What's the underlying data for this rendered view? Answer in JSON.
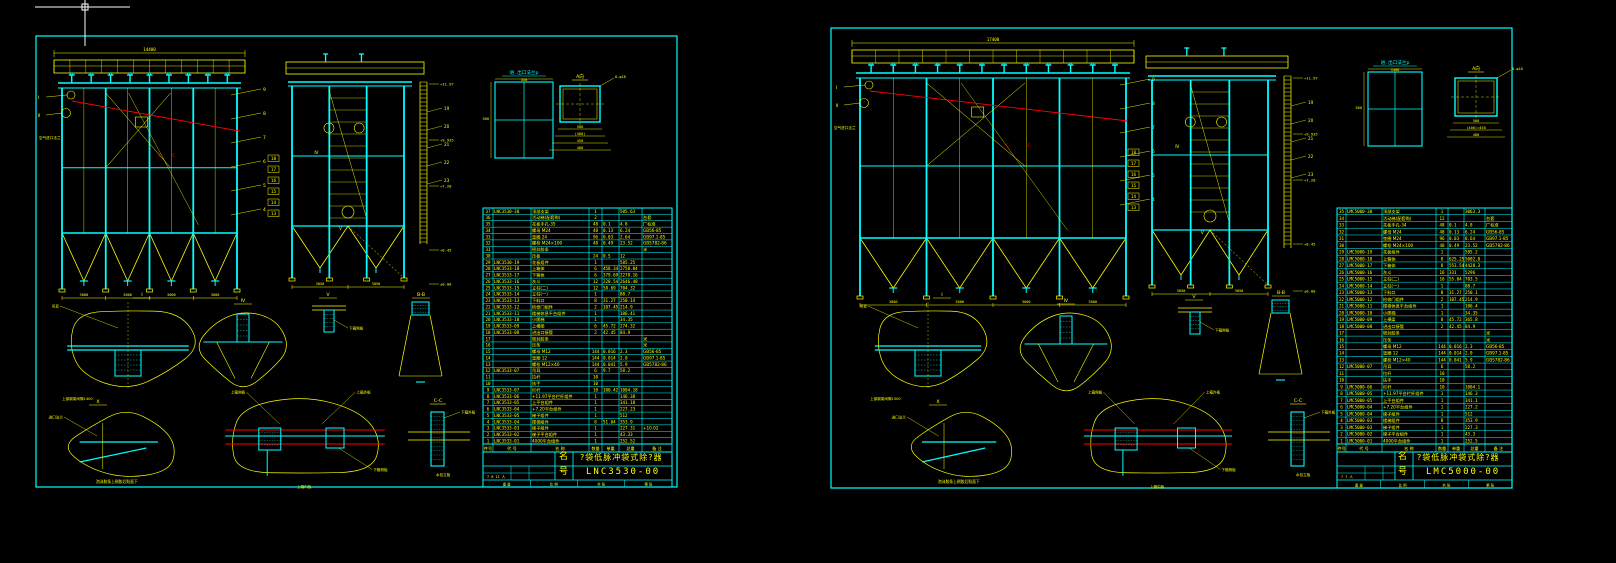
{
  "app": {
    "background": "#000000",
    "colors": {
      "cyan": "#00ffff",
      "yellow": "#ffff00",
      "red": "#ff0000",
      "white": "#ffffff"
    }
  },
  "cursor": {
    "type": "crosshair-with-pickbox"
  },
  "sheets": [
    {
      "id": "left",
      "title_block": {
        "name_label": "名",
        "name_value": "?袋低脉冲袋式除?器",
        "no_label": "号",
        "no_value": "LNC3530-00",
        "bottom_cells": [
          "重 量",
          "比 例",
          "共 张",
          "第 张"
        ],
        "sign_cells": "7 8 11 人"
      },
      "views": {
        "main": {
          "top_dim": "14400",
          "bottom_dims": [
            "3000",
            "3000",
            "3000",
            "3000"
          ],
          "balloons_right": [
            "9",
            "8",
            "7",
            "6",
            "5",
            "4"
          ],
          "left_markers": [
            "Ⅰ",
            "Ⅱ"
          ],
          "air_inlet_label": "空气进口法兰",
          "section_marks": [
            "C",
            "C"
          ]
        },
        "side": {
          "elevations": [
            "+11.97",
            "+9.935",
            "+7.20",
            "+0.45",
            "±0.00"
          ],
          "balloons_right": [
            "19",
            "20",
            "21",
            "22",
            "23"
          ],
          "balloons_left": [
            "18",
            "17",
            "16",
            "15",
            "14",
            "13"
          ],
          "markers": [
            "Ⅳ",
            "Ⅴ"
          ],
          "bottom_dims": [
            "3050",
            "3050"
          ]
        },
        "flange": {
          "label": "进, 出口法兰p",
          "width_dim": "350",
          "height_dim": "500"
        },
        "a_view": {
          "label": "A向",
          "note": "8-φ18",
          "dims": [
            "500",
            "(400)",
            "450",
            "480"
          ]
        },
        "details": {
          "labels": [
            "Ⅰ",
            "Ⅳ",
            "Ⅴ",
            "B-B",
            "Ⅹ",
            "C-C"
          ],
          "notes": [
            "吊耳",
            "上部钢架间隙1400",
            "上箱侧板",
            "下箱侧板",
            "上箱内板",
            "上箱外板",
            "下箱外板",
            "进口法兰",
            "泡沫胶条上刷胶后贴面下",
            "水包立板"
          ]
        }
      },
      "bom": {
        "headers": [
          "件号",
          "代  号",
          "名  称",
          "数量",
          "单重",
          "总重",
          "备 注"
        ],
        "rows": [
          [
            "37",
            "LNC3530-30",
            "顶部支架",
            "1",
            "",
            "505.63",
            ""
          ],
          [
            "36",
            "",
            "活动梯(配套购)",
            "2",
            "",
            "",
            "台套"
          ],
          [
            "35",
            "",
            "花板手孔-35",
            "48",
            "0.1",
            "4.8",
            "厂标准"
          ],
          [
            "34",
            "",
            "螺母 M24",
            "48",
            "0.13",
            "6.24",
            "GB56-85"
          ],
          [
            "33",
            "",
            "垫圈 24",
            "96",
            "0.03",
            "2.64",
            "GB97.1-85"
          ],
          [
            "32",
            "",
            "螺栓 M24×100",
            "48",
            "0.49",
            "23.52",
            "GB5782-86"
          ],
          [
            "31",
            "",
            "密封胶条",
            "",
            "",
            "",
            "米"
          ],
          [
            "30",
            "",
            "压板",
            "24",
            "0.5",
            "12",
            ""
          ],
          [
            "29",
            "LNC3530-19",
            "花板组件",
            "1",
            "",
            "585.25",
            ""
          ],
          [
            "28",
            "LNC3533-18",
            "上箱体",
            "6",
            "458.34",
            "2750.04",
            ""
          ],
          [
            "27",
            "LNC3533-17",
            "下箱体",
            "6",
            "379.69",
            "2278.16",
            ""
          ],
          [
            "26",
            "LNC3533-16",
            "灰斗",
            "12",
            "220.54",
            "2646.48",
            ""
          ],
          [
            "25",
            "LNC3533-15",
            "立柱(二)",
            "12",
            "58.69",
            "704.32",
            ""
          ],
          [
            "24",
            "LNC3533-14",
            "立柱(一)",
            "1",
            "",
            "88.7",
            ""
          ],
          [
            "23",
            "LNC3533-13",
            "下料口",
            "8",
            "31.27",
            "250.14",
            ""
          ],
          [
            "22",
            "LNC3533-12",
            "检修门组件",
            "2",
            "107.45",
            "214.9",
            ""
          ],
          [
            "21",
            "LNC3533-11",
            "楼梯休息平台组件",
            "1",
            "",
            "106.41",
            ""
          ],
          [
            "20",
            "LNC3533-10",
            "小爬梯",
            "1",
            "",
            "34.35",
            ""
          ],
          [
            "19",
            "LNC3533-09",
            "上横梁",
            "6",
            "45.72",
            "274.32",
            ""
          ],
          [
            "18",
            "LNC3533-08",
            "进出口接管",
            "2",
            "42.45",
            "84.9",
            ""
          ],
          [
            "17",
            "",
            "密封胶条",
            "",
            "",
            "",
            "米"
          ],
          [
            "16",
            "",
            "压条",
            "",
            "",
            "",
            "米"
          ],
          [
            "15",
            "",
            "螺母 M12",
            "144",
            "0.016",
            "2.3",
            "GB56-85"
          ],
          [
            "14",
            "",
            "垫圈 12",
            "144",
            "0.014",
            "2.0",
            "GB97.1-85"
          ],
          [
            "13",
            "",
            "螺栓 M12×40",
            "144",
            "0.041",
            "5.9",
            "GB5782-86"
          ],
          [
            "12",
            "LNC3533-07",
            "吊耳",
            "6",
            "9.7",
            "58.2",
            ""
          ],
          [
            "11",
            "",
            "拉杆",
            "10",
            "",
            "",
            ""
          ],
          [
            "10",
            "",
            "扶手",
            "10",
            "",
            "",
            ""
          ],
          [
            "9",
            "LNC3533-07",
            "栏杆",
            "10",
            "100.42",
            "1004.18",
            ""
          ],
          [
            "8",
            "LNC3533-06",
            "+11.97平台栏杆组件",
            "1",
            "",
            "146.38",
            ""
          ],
          [
            "7",
            "LNC3533-05",
            "上平台组件",
            "1",
            "",
            "341.18",
            ""
          ],
          [
            "6",
            "LNC3533-04",
            "+7.20平台组件",
            "1",
            "",
            "227.23",
            ""
          ],
          [
            "5",
            "LNC3533-05",
            "梯子组件",
            "1",
            "",
            "512",
            ""
          ],
          [
            "4",
            "LNC3533-04",
            "楼梯组件",
            "8",
            "51.04",
            "353.9",
            ""
          ],
          [
            "3",
            "LNC3533-03",
            "梯子组件",
            "1",
            "",
            "227.31",
            "+10.02"
          ],
          [
            "2",
            "LNC3533-02",
            "梯子平台组件",
            "1",
            "",
            "43.33",
            ""
          ],
          [
            "1",
            "LNC3533-01",
            "4000平台组件",
            "1",
            "",
            "252.52",
            ""
          ]
        ]
      }
    },
    {
      "id": "right",
      "title_block": {
        "name_label": "名",
        "name_value": "?袋低脉冲袋式除?器",
        "no_label": "号",
        "no_value": "LMC5000-00",
        "bottom_cells": [
          "重 量",
          "比 例",
          "共 张",
          "第 张"
        ],
        "sign_cells": "7 7 人"
      },
      "views": {
        "main": {
          "top_dim": "17400",
          "bottom_dims": [
            "3000",
            "3000",
            "3000",
            "3000"
          ],
          "balloons_right": [
            "9",
            "8",
            "7",
            "6",
            "5",
            "4"
          ],
          "left_markers": [
            "Ⅰ",
            "Ⅱ"
          ],
          "air_inlet_label": "空气进口法兰",
          "section_marks": [
            "C",
            "C"
          ]
        },
        "side": {
          "elevations": [
            "+11.97",
            "+9.935",
            "+7.20",
            "+0.45",
            "±0.00"
          ],
          "balloons_right": [
            "19",
            "20",
            "21",
            "22",
            "23"
          ],
          "balloons_left": [
            "18",
            "17",
            "16",
            "15",
            "14",
            "13"
          ],
          "markers": [
            "Ⅳ",
            "Ⅴ"
          ],
          "bottom_dims": [
            "3050",
            "3050"
          ]
        },
        "flange": {
          "label": "进, 出口法兰p",
          "width_dim": "3480",
          "height_dim": "500"
        },
        "a_view": {
          "label": "A向",
          "note": "B-φ18",
          "dims": [
            "500",
            "(400)=450",
            "480"
          ]
        },
        "details": {
          "labels": [
            "Ⅰ",
            "Ⅳ",
            "Ⅴ",
            "B-B",
            "Ⅹ",
            "C-C"
          ],
          "notes": [
            "吊耳",
            "上部钢架间隙1500",
            "上箱侧板",
            "下箱侧板",
            "上箱内板",
            "上箱外板",
            "下箱外板",
            "进口法兰",
            "泡沫胶条上刷胶后贴面下",
            "水包立板"
          ]
        }
      },
      "bom": {
        "headers": [
          "件号",
          "代  号",
          "名  称",
          "数量",
          "单重",
          "总重",
          "备 注"
        ],
        "rows": [
          [
            "35",
            "LMC5000-30",
            "顶部支架",
            "1",
            "",
            "3063.3",
            ""
          ],
          [
            "34",
            "",
            "活动梯(配套购)",
            "12",
            "",
            "",
            "台套"
          ],
          [
            "33",
            "",
            "花板手孔-34",
            "48",
            "0.1",
            "4.8",
            "厂标准"
          ],
          [
            "32",
            "",
            "螺母 M24",
            "48",
            "0.13",
            "6.24",
            "GB56-85"
          ],
          [
            "31",
            "",
            "垫圈 M24",
            "96",
            "0.03",
            "8.64",
            "GB97.1-85"
          ],
          [
            "30",
            "",
            "螺栓 M24×100",
            "48",
            "0.49",
            "23.52",
            "GB5782-86"
          ],
          [
            "29",
            "LMC5000-19",
            "花板组件",
            "1",
            "",
            "585.2",
            ""
          ],
          [
            "28",
            "LMC5000-18",
            "上箱体",
            "8",
            "625.25",
            "5002.0",
            ""
          ],
          [
            "27",
            "LMC5000-17",
            "下箱体",
            "8",
            "553.54",
            "4428.3",
            ""
          ],
          [
            "26",
            "LMC5000-16",
            "灰斗",
            "16",
            "331",
            "5296",
            ""
          ],
          [
            "25",
            "LMC5000-15",
            "立柱(二)",
            "16",
            "55.04",
            "703.5",
            ""
          ],
          [
            "24",
            "LMC5000-14",
            "立柱(一)",
            "1",
            "",
            "88.7",
            ""
          ],
          [
            "23",
            "LMC5000-13",
            "下料口",
            "8",
            "31.27",
            "250.1",
            ""
          ],
          [
            "22",
            "LMC5000-12",
            "检修门组件",
            "2",
            "107.45",
            "214.9",
            ""
          ],
          [
            "21",
            "LMC5000-11",
            "楼梯休息平台组件",
            "1",
            "",
            "106.4",
            ""
          ],
          [
            "20",
            "LMC5000-10",
            "小爬梯",
            "1",
            "",
            "34.35",
            ""
          ],
          [
            "19",
            "LMC5000-09",
            "上横梁",
            "8",
            "45.72",
            "365.8",
            ""
          ],
          [
            "18",
            "LMC5000-08",
            "进出口接管",
            "2",
            "42.45",
            "84.9",
            ""
          ],
          [
            "17",
            "",
            "密封胶条",
            "",
            "",
            "",
            "米"
          ],
          [
            "16",
            "",
            "压条",
            "",
            "",
            "",
            "米"
          ],
          [
            "15",
            "",
            "螺母 M12",
            "144",
            "0.016",
            "2.3",
            "GB56-85"
          ],
          [
            "14",
            "",
            "垫圈 12",
            "144",
            "0.014",
            "2.0",
            "GB97.1-85"
          ],
          [
            "13",
            "",
            "螺栓 M12×40",
            "144",
            "0.041",
            "5.9",
            "GB5782-86"
          ],
          [
            "12",
            "LMC5000-07",
            "吊耳",
            "6",
            "",
            "58.2",
            ""
          ],
          [
            "11",
            "",
            "拉杆",
            "10",
            "",
            "",
            ""
          ],
          [
            "10",
            "",
            "扶手",
            "10",
            "",
            "",
            ""
          ],
          [
            "9",
            "LMC5000-06",
            "栏杆",
            "10",
            "",
            "1004.1",
            ""
          ],
          [
            "8",
            "LMC5000-05",
            "+11.97平台栏杆组件",
            "1",
            "",
            "146.3",
            ""
          ],
          [
            "7",
            "LMC5000-05",
            "上平台组件",
            "1",
            "",
            "341.1",
            ""
          ],
          [
            "6",
            "LMC5000-04",
            "+7.20平台组件",
            "1",
            "",
            "227.2",
            ""
          ],
          [
            "5",
            "LMC5000-04",
            "梯子组件",
            "1",
            "",
            "512",
            ""
          ],
          [
            "4",
            "LMC5000-03",
            "楼梯组件",
            "8",
            "",
            "353.9",
            ""
          ],
          [
            "3",
            "LMC5000-03",
            "梯子组件",
            "1",
            "",
            "227.3",
            ""
          ],
          [
            "2",
            "LMC5000-02",
            "梯子平台组件",
            "1",
            "",
            "43.3",
            ""
          ],
          [
            "1",
            "LMC5000-01",
            "4000平台组件",
            "1",
            "",
            "252.5",
            ""
          ]
        ]
      }
    }
  ]
}
